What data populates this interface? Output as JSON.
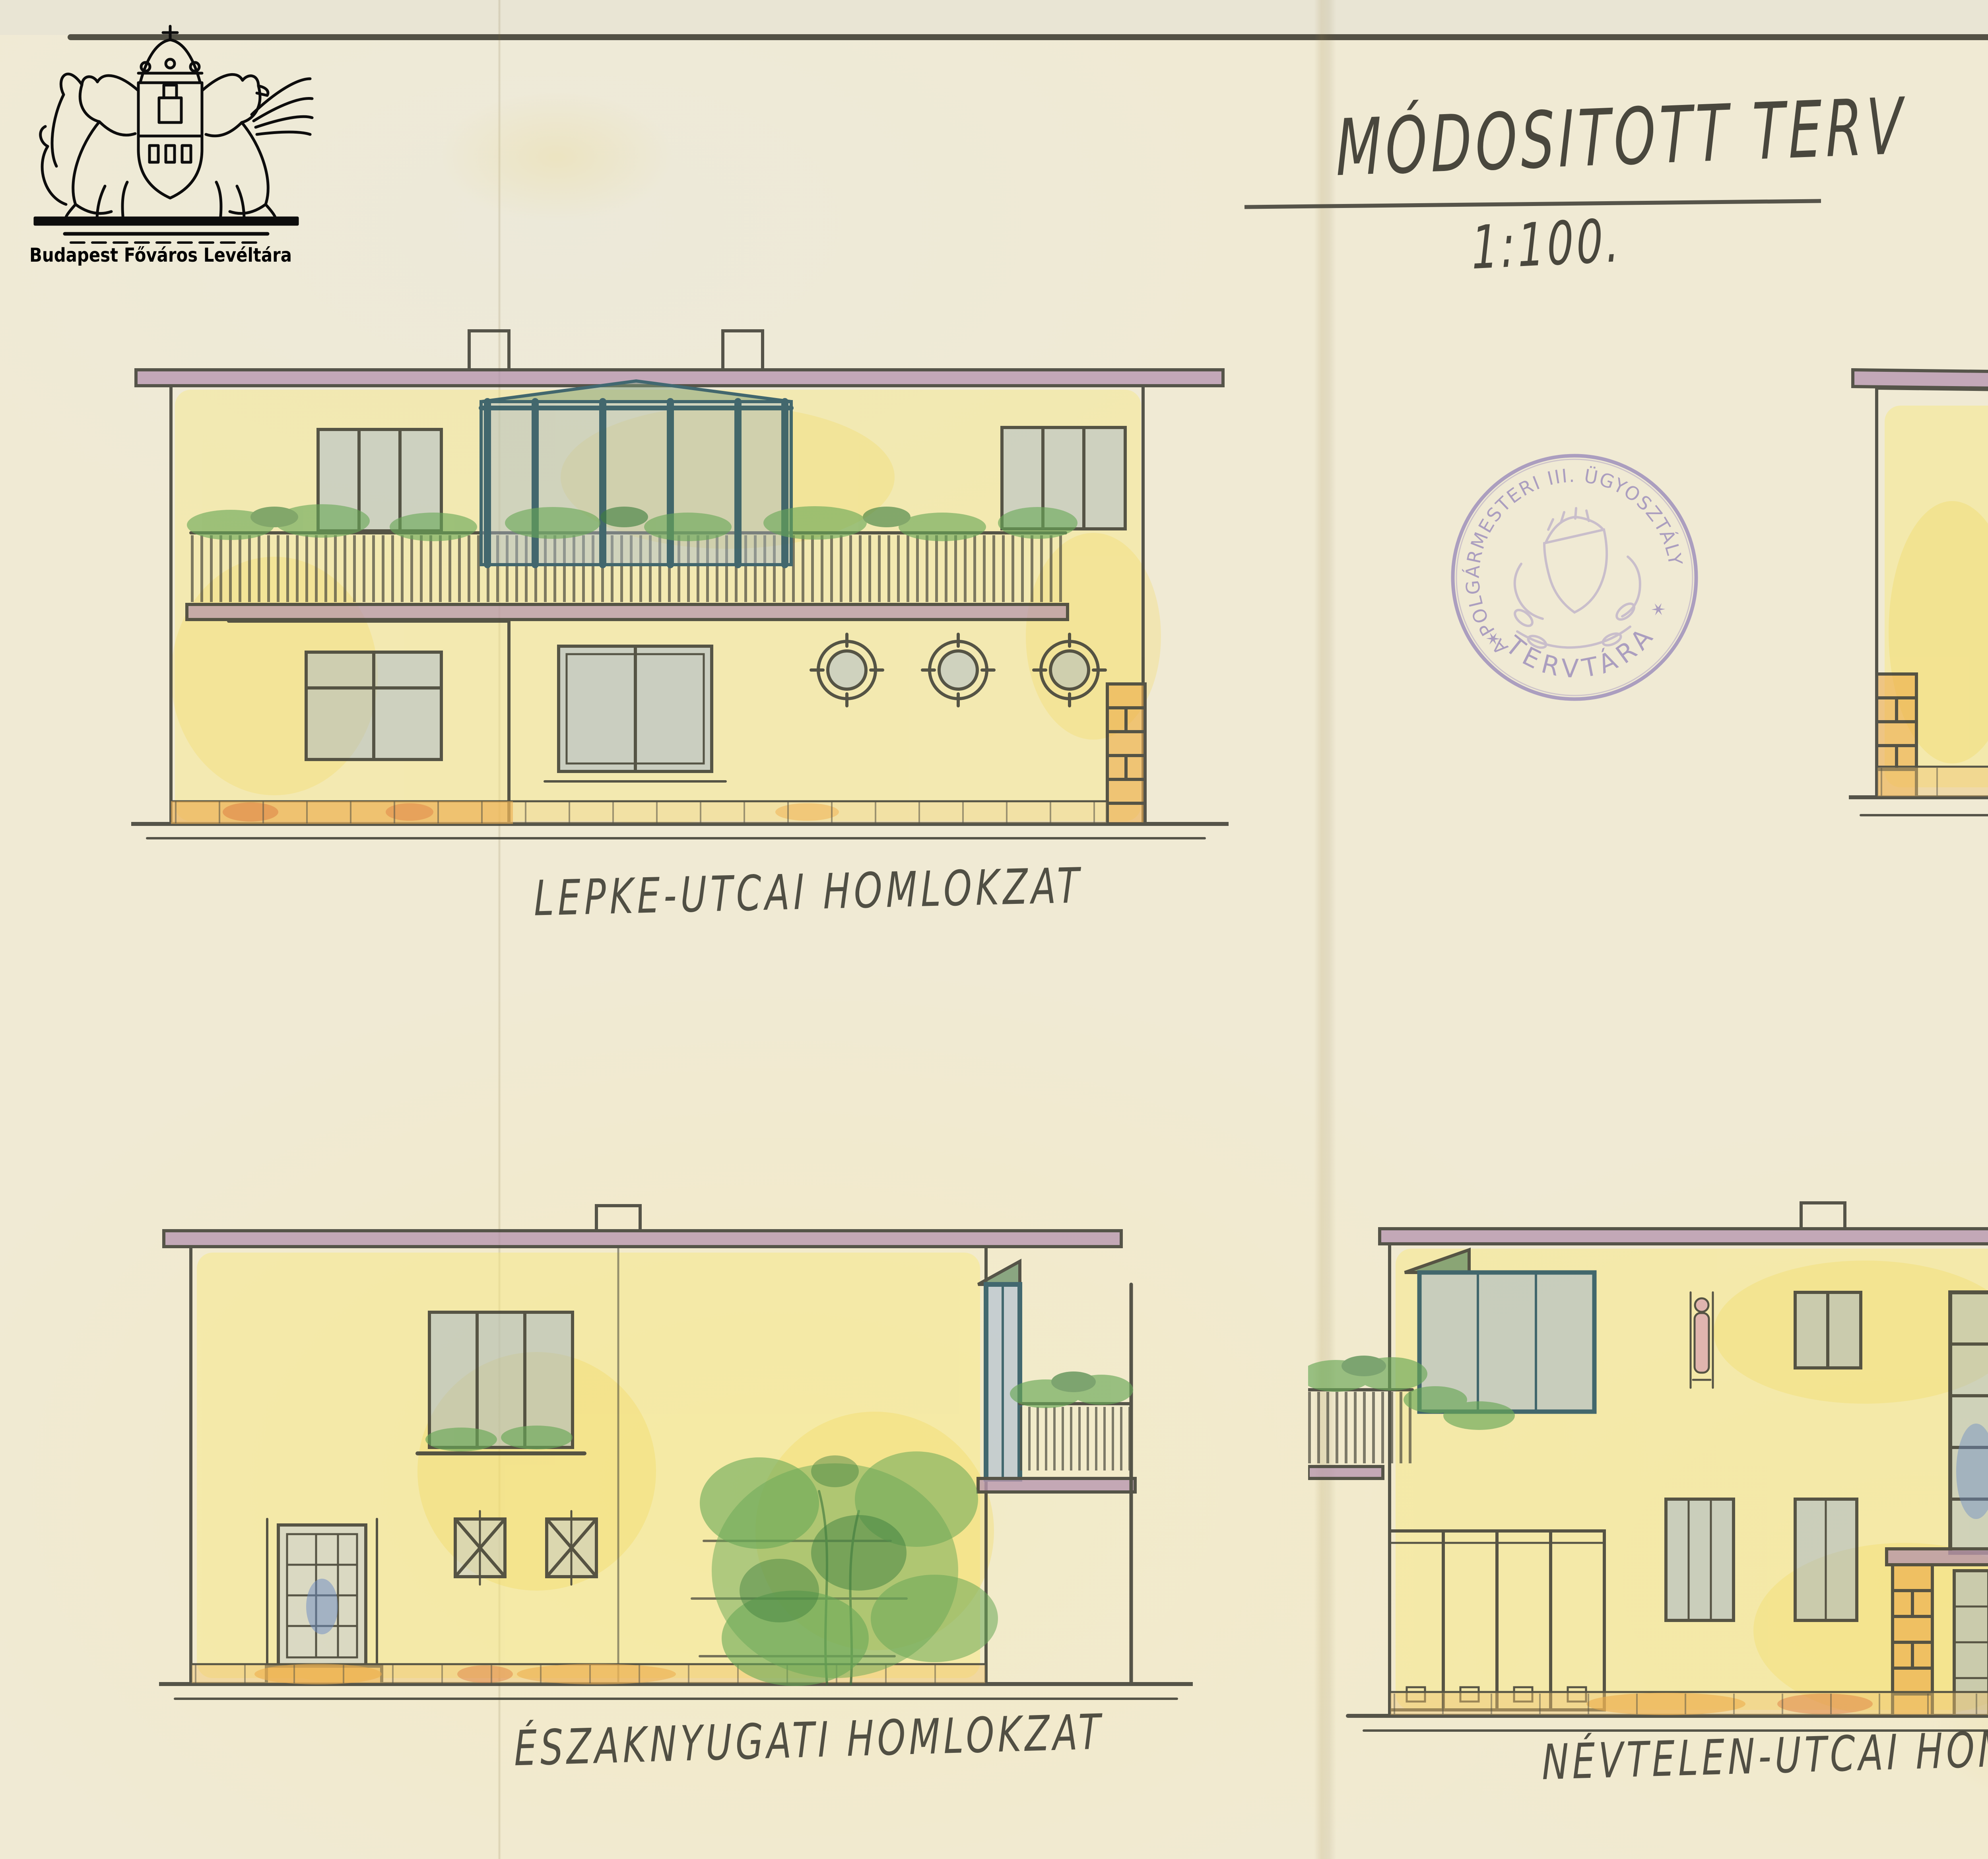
{
  "archive": {
    "caption": "Budapest Főváros Levéltára"
  },
  "title": {
    "main": "MÓDOSITOTT TERV",
    "scale": "1:100."
  },
  "page_ref": "44.SZ.R",
  "stamp": {
    "top": "A POLGÁRMESTERI III. ÜGYOSZTÁLY",
    "bottom": "TERVTÁRA",
    "star": "✶"
  },
  "elevations": {
    "lepke": {
      "label": "LEPKE-UTCAI HOMLOKZAT"
    },
    "northeast": {
      "label": "ÉSZAKKELETI HOMLOKZAT"
    },
    "northwest": {
      "label": "ÉSZAKNYUGATI HOMLOKZAT"
    },
    "nevtelen": {
      "label": "NÉVTELEN-UTCAI HOMLOKZAT"
    }
  },
  "dimension": {
    "height": "7,95"
  },
  "note": {
    "lines": [
      "NAGYSÁGOS",
      "DR. IRSAI ERNŐNÉ ~",
      "SZÜL. BRATANITS TERÉZ",
      "ÚRNŐ",
      "BÉRVILLA-ÉPITKEZÉSE",
      "BUDAPEST, II. LEPKE-U. 23.",
      "12372/1. HRSZ.",
      "SZIVESSY TIBOR ÉPITÉSZMÉRNÖK",
      "BUDAPEST, 1940. NOVEMBER 4."
    ]
  },
  "signatures": {
    "owner_line1": "Dr Irsai Ernőné",
    "owner_line2": "Bratanits Teréz"
  },
  "colors": {
    "ink": "#45443a",
    "mauve": "#b18fad",
    "wash_yellow": "#f8e87d",
    "glass_blue": "#8fa9d6",
    "plant_green": "#69a857",
    "stone_orange": "#eda843",
    "stamp_purple": "#9b8cba",
    "paper": "#f0ead4"
  }
}
